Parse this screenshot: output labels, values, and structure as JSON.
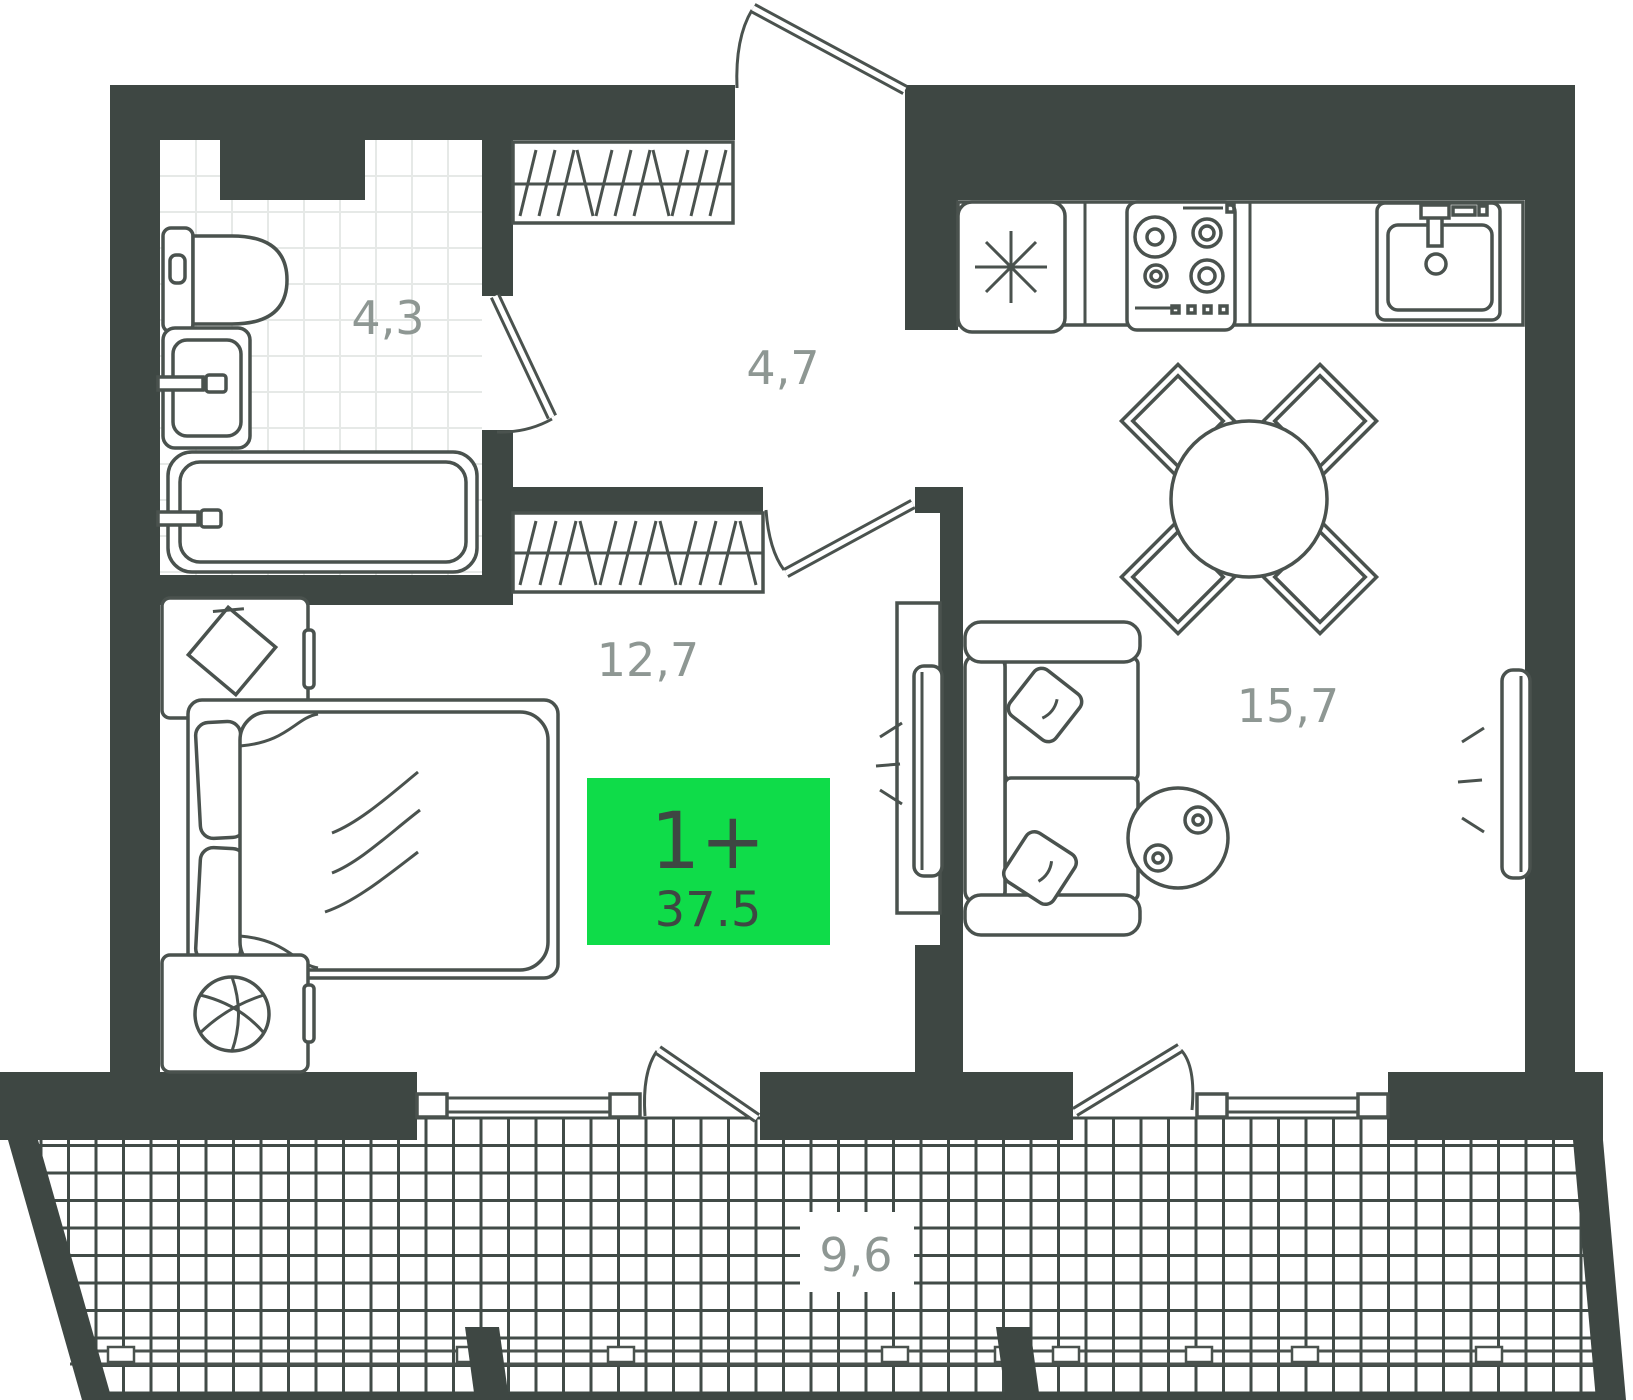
{
  "plan": {
    "badge": {
      "type_label": "1+",
      "area": "37.5"
    },
    "rooms": [
      {
        "name": "bathroom",
        "area": "4,3"
      },
      {
        "name": "hallway",
        "area": "4,7"
      },
      {
        "name": "bedroom",
        "area": "12,7"
      },
      {
        "name": "living-kitchen",
        "area": "15,7"
      },
      {
        "name": "balcony",
        "area": "9,6"
      }
    ],
    "colors": {
      "wall": "#3E4743",
      "accent": "#0FDC49",
      "furniture_line": "#4A524E",
      "label_text": "#8E9793",
      "badge_text": "#3E4743",
      "tile_line": "#E6E9E7",
      "mesh_line": "#414B47"
    }
  }
}
